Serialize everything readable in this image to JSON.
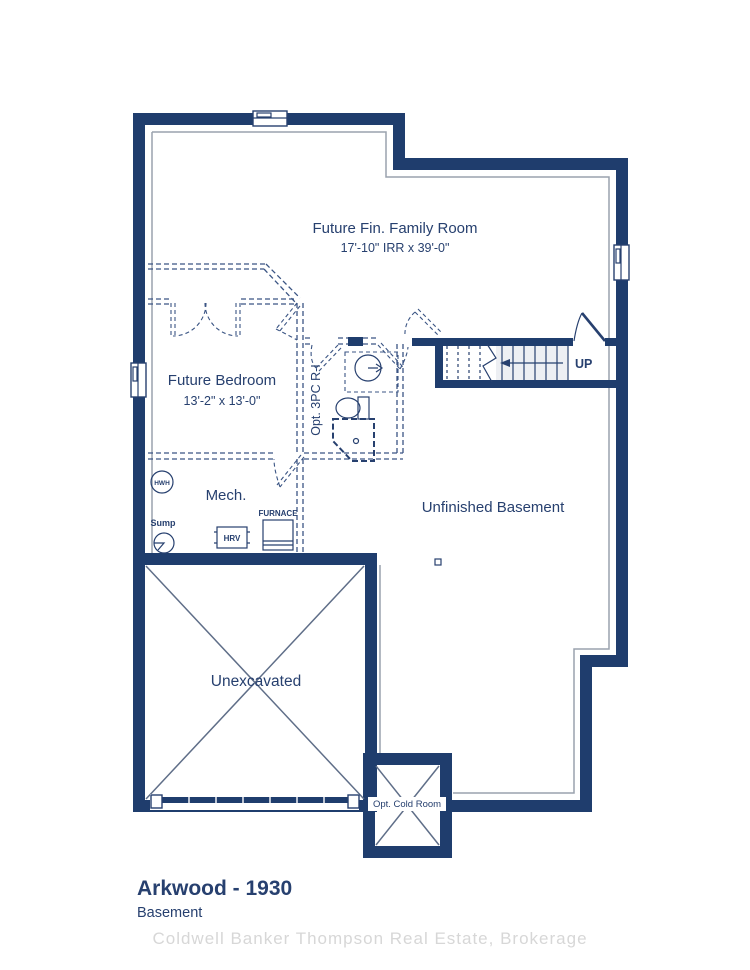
{
  "colors": {
    "wall": "#1f3d6d",
    "text": "#27406f",
    "foundation_line": "#9aa2ad",
    "unexcavated_cross": "#5f6e88",
    "watermark": "#d7d7d7"
  },
  "plan": {
    "rooms": {
      "family_room": {
        "name": "Future Fin. Family Room",
        "dims": "17'-10\" IRR x 39'-0\""
      },
      "bedroom": {
        "name": "Future Bedroom",
        "dims": "13'-2\" x 13'-0\""
      },
      "bathroom": {
        "name": "Opt. 3PC R-I"
      },
      "mech": {
        "name": "Mech."
      },
      "unfinished": {
        "name": "Unfinished Basement"
      },
      "unexcavated": {
        "name": "Unexcavated"
      },
      "cold_room": {
        "name": "Opt. Cold Room"
      }
    },
    "equipment": {
      "hwh": "HWH",
      "sump": "Sump",
      "hrv": "HRV",
      "furnace": "FURNACE"
    },
    "stairs": {
      "direction_label": "UP"
    }
  },
  "footer": {
    "title": "Arkwood - 1930",
    "subtitle": "Basement"
  },
  "watermark": "Coldwell Banker Thompson Real Estate, Brokerage"
}
